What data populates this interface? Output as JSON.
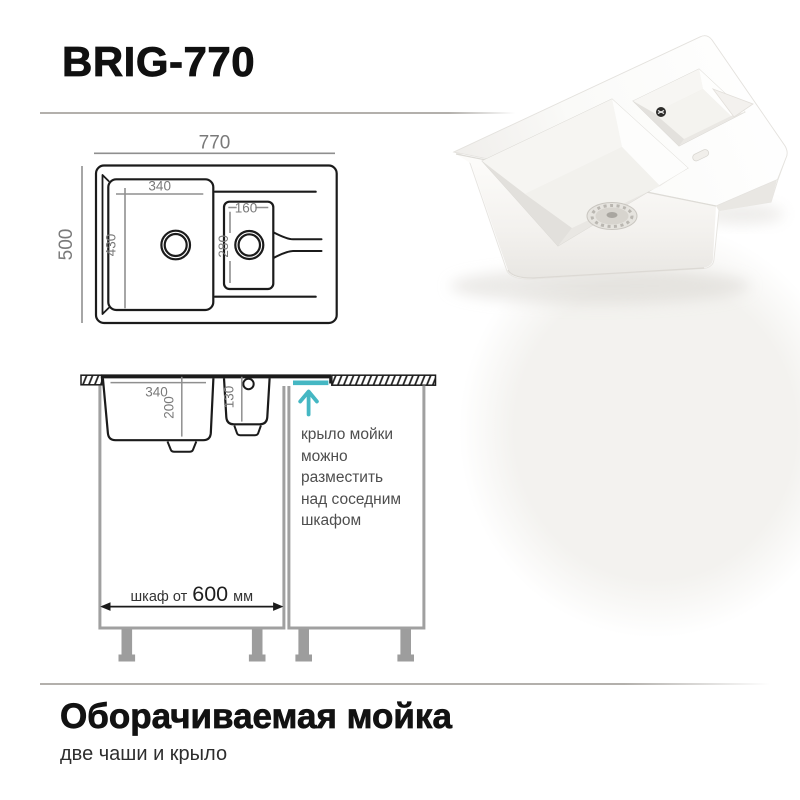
{
  "header": {
    "title": "BRIG-770"
  },
  "top_view": {
    "overall_width": "770",
    "overall_depth": "500",
    "main_bowl": {
      "width": "340",
      "depth": "430"
    },
    "extra_bowl": {
      "width": "160",
      "depth": "280"
    }
  },
  "side_view": {
    "main_bowl_width": "340",
    "main_bowl_depth": "200",
    "extra_bowl_depth": "130",
    "cabinet_prefix": "шкаф от",
    "cabinet_value": "600",
    "cabinet_unit": "мм",
    "note_lines": [
      "крыло мойки",
      "можно",
      "разместить",
      "над соседним",
      "шкафом"
    ],
    "accent_color": "#45b7c3"
  },
  "footer": {
    "title": "Оборачиваемая мойка",
    "subtitle": "две чаши и крыло"
  }
}
